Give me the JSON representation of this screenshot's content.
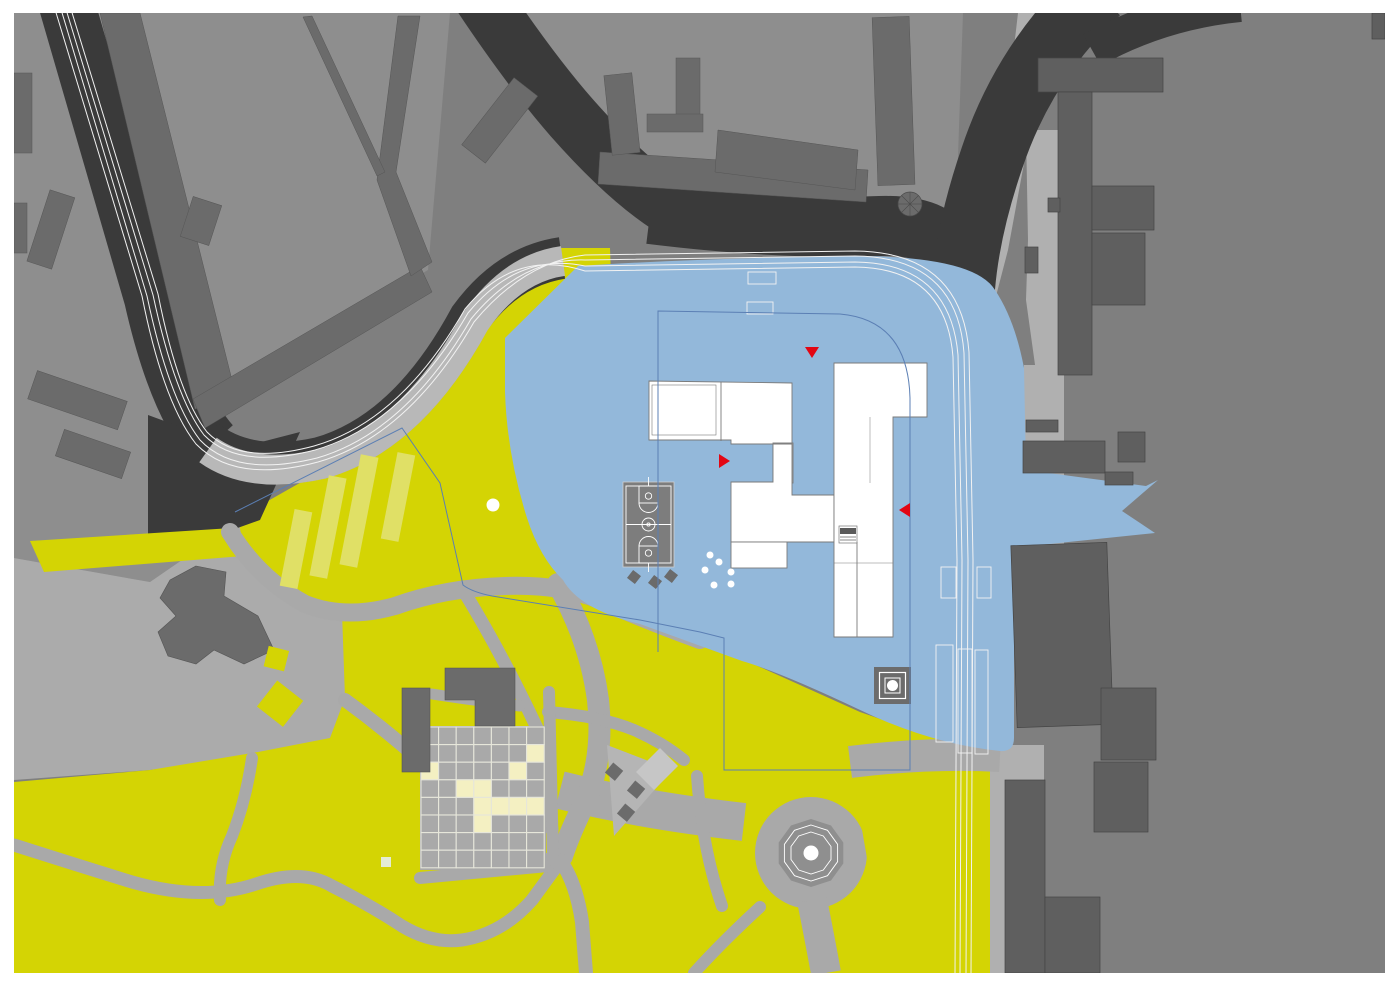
{
  "map": {
    "kind": "architectural-site-plan",
    "description": "urban site plan with highlighted school parcel, park and tram corridor",
    "colors": {
      "margin": "#ffffff",
      "field": "#7f7f7f",
      "block_light": "#8e8e8e",
      "plaza": "#ababab",
      "sidewalk": "#b0b0b0",
      "path": "#a9a9a9",
      "band": "#b8b8b8",
      "street": "#3a3a3a",
      "building_mid": "#6b6b6b",
      "building_dark": "#5f5f5f",
      "building_outline": "#4a4a4a",
      "park_yellow": "#d4d404",
      "stripe_yellow": "#e0e066",
      "cell_cream": "#f4f0c2",
      "cell_gray": "#a9a9a9",
      "grid_line": "#e6e6da",
      "pale_green": "#e4ecd4",
      "site_blue": "#93b8da",
      "boundary_blue": "#5b7fb4",
      "white_building": "#ffffff",
      "white_building_outline": "#7a7a7a",
      "marker_red": "#e30613",
      "track_white": "#f2f2f2",
      "court_gray": "#7d7d7d",
      "fountain_gray": "#8f8f8f",
      "monument_gray": "#6c6c6c",
      "white_dot": "#ffffff"
    },
    "markers": [
      {
        "name": "entrance-marker-north",
        "x": 812,
        "y": 352,
        "dir": "down"
      },
      {
        "name": "entrance-marker-west",
        "x": 723,
        "y": 461,
        "dir": "right"
      },
      {
        "name": "entrance-marker-east",
        "x": 906,
        "y": 510,
        "dir": "left"
      }
    ],
    "trees": [
      {
        "x": 710,
        "y": 555,
        "r": 3.5
      },
      {
        "x": 719,
        "y": 562,
        "r": 3.5
      },
      {
        "x": 705,
        "y": 570,
        "r": 3.5
      },
      {
        "x": 731,
        "y": 572,
        "r": 3.5
      },
      {
        "x": 714,
        "y": 585,
        "r": 3.5
      },
      {
        "x": 731,
        "y": 584,
        "r": 3.5
      },
      {
        "x": 493,
        "y": 505,
        "r": 6.5
      }
    ],
    "parking_bays": [
      {
        "x": 941,
        "y": 567,
        "w": 15,
        "h": 31
      },
      {
        "x": 977,
        "y": 567,
        "w": 14,
        "h": 31
      },
      {
        "x": 936,
        "y": 645,
        "w": 17,
        "h": 97
      },
      {
        "x": 958,
        "y": 649,
        "w": 14,
        "h": 104
      },
      {
        "x": 975,
        "y": 650,
        "w": 13,
        "h": 104
      }
    ],
    "crosswalks": [
      {
        "x": 748,
        "y": 272,
        "w": 28,
        "h": 12
      },
      {
        "x": 747,
        "y": 302,
        "w": 26,
        "h": 12
      }
    ],
    "garden_grid": {
      "origin_x": 421,
      "origin_y": 727,
      "cell": 17.6,
      "cols": 7,
      "rows": 8,
      "cream_cells": [
        [
          6,
          1
        ],
        [
          5,
          2
        ],
        [
          0,
          2
        ],
        [
          2,
          3
        ],
        [
          3,
          3
        ],
        [
          3,
          4
        ],
        [
          4,
          4
        ],
        [
          5,
          4
        ],
        [
          6,
          4
        ],
        [
          3,
          5
        ]
      ]
    },
    "stripes": [
      {
        "cx": 296,
        "cy": 549,
        "len": 78,
        "w": 18,
        "rot": 11
      },
      {
        "cx": 328,
        "cy": 527,
        "len": 102,
        "w": 18,
        "rot": 11
      },
      {
        "cx": 359,
        "cy": 511,
        "len": 112,
        "w": 18,
        "rot": 11
      },
      {
        "cx": 398,
        "cy": 497,
        "len": 88,
        "w": 18,
        "rot": 11
      }
    ],
    "fountain": {
      "cx": 811,
      "cy": 853,
      "r_outer": 34,
      "r_ring1": 28,
      "r_ring2": 21,
      "r_center": 7.5
    },
    "turret": {
      "cx": 910,
      "cy": 204,
      "r": 12,
      "spokes": 8
    },
    "monument": {
      "x": 874,
      "y": 667,
      "size": 37
    }
  }
}
